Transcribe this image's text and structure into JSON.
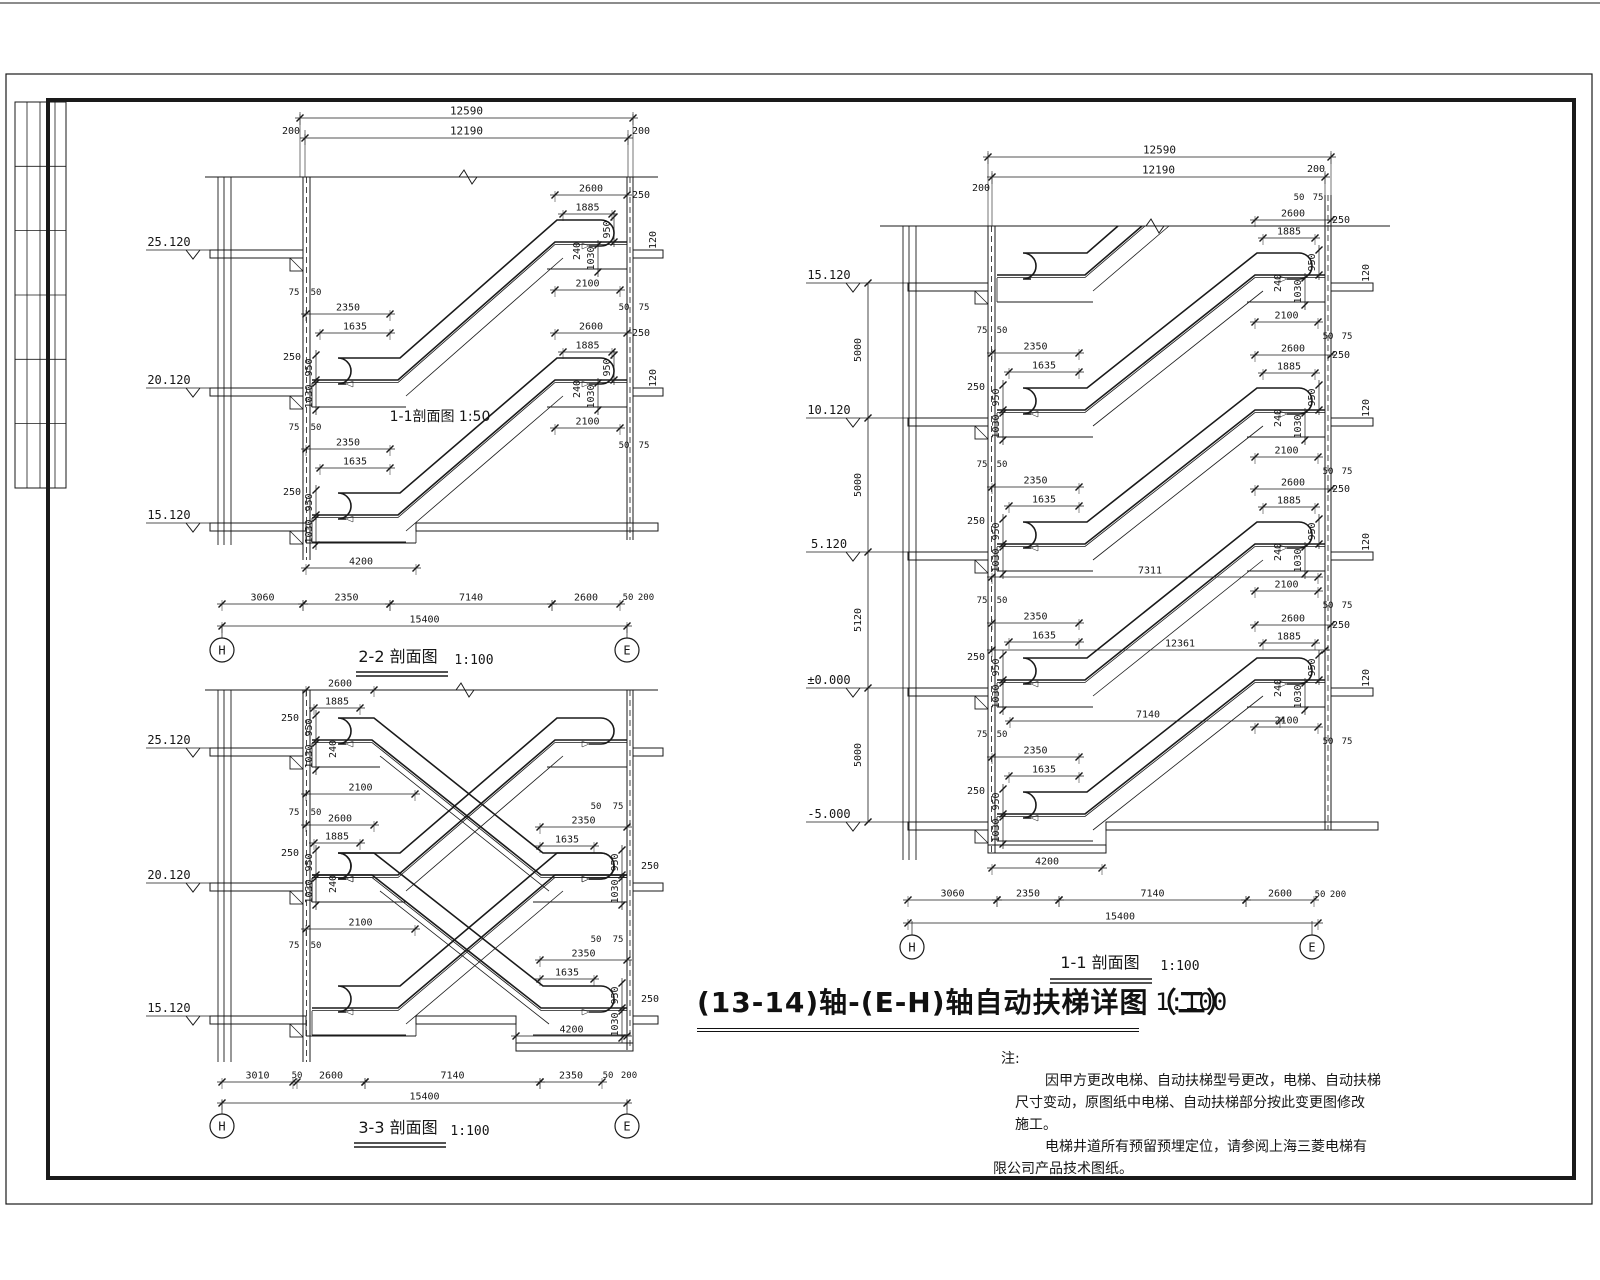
{
  "sheet": {
    "main_title": "(13-14)轴-(E-H)轴自动扶梯详图（二）",
    "main_scale": "1:100",
    "notes_header": "注:",
    "notes": [
      "因甲方更改电梯、自动扶梯型号更改，电梯、自动扶梯",
      "尺寸变动，原图纸中电梯、自动扶梯部分按此变更图修改",
      "施工。",
      "电梯井道所有预留预埋定位，请参阅上海三菱电梯有",
      "限公司产品技术图纸。"
    ]
  },
  "sections": {
    "s22": {
      "name": "2-2 剖面图",
      "scale": "1:100",
      "inner_label": "1-1剖面图 1:50"
    },
    "s33": {
      "name": "3-3 剖面图",
      "scale": "1:100"
    },
    "s11": {
      "name": "1-1 剖面图",
      "scale": "1:100"
    }
  },
  "grid": {
    "h": "H",
    "e": "E"
  },
  "elevations": {
    "e25": "25.120",
    "e20": "20.120",
    "e15": "15.120",
    "e10": "10.120",
    "e5": "5.120",
    "e0": "±0.000",
    "em5": "-5.000"
  },
  "dims": {
    "d12590": "12590",
    "d12190": "12190",
    "d15400": "15400",
    "d12361": "12361",
    "d7311": "7311",
    "d7140": "7140",
    "d5000": "5000",
    "d5120": "5120",
    "d4200": "4200",
    "d3060": "3060",
    "d3010": "3010",
    "d2600": "2600",
    "d2350": "2350",
    "d2100": "2100",
    "d1885": "1885",
    "d1635": "1635",
    "d1030": "1030",
    "d950": "950",
    "d250": "250",
    "d240": "240",
    "d200": "200",
    "d120": "120",
    "d75": "75",
    "d50": "50"
  }
}
